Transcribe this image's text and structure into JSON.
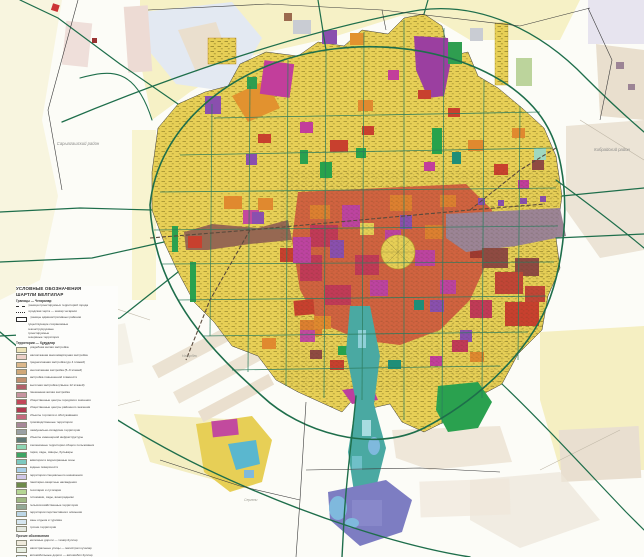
{
  "map": {
    "type": "city-master-plan",
    "region_labels": [
      {
        "id": "left",
        "text": "Сарыагашский район"
      },
      {
        "id": "right",
        "text": "Кибрайский район"
      }
    ],
    "place_labels": [
      {
        "id": "sw-settlement",
        "text": "Назарбек"
      },
      {
        "id": "s-settlement",
        "text": "Сергели"
      }
    ],
    "colors": {
      "background": "#fcfcf7",
      "pale_fields": "#f6f1c6",
      "outskirt_beige": "#ebe2d2",
      "city_yellow": "#e7cf56",
      "street_texture": "#6b5e14",
      "highway_green": "#1e6e4b",
      "grid_teal": "#2c7c5e",
      "park_green": "#27a24c",
      "residential_red": "#cf5a3e",
      "crimson": "#c13a57",
      "magenta": "#c23e9b",
      "purple": "#8a4fae",
      "orange": "#e0892f",
      "industrial_mauve": "#9c8495",
      "rail_brown": "#966852",
      "canal_teal": "#4aa9a2",
      "lake_blue": "#7fb9dd",
      "special_slate": "#7d7dc2",
      "boundary_black": "#3a3a3a"
    }
  },
  "legend": {
    "title_ru": "УСЛОВНЫЕ ОБОЗНАЧЕНИЯ",
    "title_uz": "ШАРТЛИ БЕЛГИЛАР",
    "sections": [
      {
        "header": "Границы — Чегаралар",
        "entries": [
          {
            "type": "line-dashdot",
            "label": "граница проектируемых территорий города"
          },
          {
            "type": "line-dash",
            "label": "городская черта — шахар чегараси"
          },
          {
            "type": "box",
            "label": "границы административных районов"
          }
        ]
      },
      {
        "header": "",
        "entries": [
          {
            "type": "text",
            "label": "существующие сохраняемые"
          },
          {
            "type": "text",
            "label": "реконструируемые"
          },
          {
            "type": "text",
            "label": "проектируемые"
          },
          {
            "type": "text",
            "label": "резервные территории"
          }
        ]
      },
      {
        "header": "Территории — Худудлар",
        "entries": [
          {
            "type": "swatch",
            "color": "#eee4b8",
            "label": "усадебная жилая застройка"
          },
          {
            "type": "swatch",
            "color": "#ecd0c8",
            "label": "малоэтажная многоквартирная застройка"
          },
          {
            "type": "swatch",
            "color": "#dcb88c",
            "label": "среднеэтажная застройка (до 4 этажей)"
          },
          {
            "type": "swatch",
            "color": "#d0a878",
            "label": "многоэтажная застройка (5–9 этажей)"
          },
          {
            "type": "swatch",
            "color": "#c09070",
            "label": "застройка повышенной этажности"
          },
          {
            "type": "swatch",
            "color": "#b0606a",
            "label": "высотная застройка (свыше 12 этажей)"
          },
          {
            "type": "swatch",
            "color": "#c794a0",
            "label": "смешанная жилая застройка"
          },
          {
            "type": "swatch",
            "color": "#c2485a",
            "label": "общественные центры городского значения"
          },
          {
            "type": "swatch",
            "color": "#b03a50",
            "label": "общественные центры районного значения"
          },
          {
            "type": "swatch",
            "color": "#c46a7e",
            "label": "объекты торговли и обслуживания"
          },
          {
            "type": "swatch",
            "color": "#a78898",
            "label": "производственные территории"
          },
          {
            "type": "swatch",
            "color": "#9aa0a4",
            "label": "коммунально-складские территории"
          },
          {
            "type": "swatch",
            "color": "#5f7a78",
            "label": "объекты инженерной инфраструктуры"
          },
          {
            "type": "swatch",
            "color": "#8fd6b4",
            "label": "озеленённые территории общего пользования"
          },
          {
            "type": "swatch",
            "color": "#3da564",
            "label": "парки, сады, скверы, бульвары"
          },
          {
            "type": "swatch",
            "color": "#7cc9c0",
            "label": "акватории и водоохранные зоны"
          },
          {
            "type": "swatch",
            "color": "#a9cfe8",
            "label": "водные поверхности"
          },
          {
            "type": "swatch",
            "color": "#cfc6e6",
            "label": "территории специального назначения"
          },
          {
            "type": "swatch",
            "color": "#6d8a4a",
            "label": "санитарно-защитные насаждения"
          },
          {
            "type": "swatch",
            "color": "#b5d694",
            "label": "лесопарки и лугопарки"
          },
          {
            "type": "swatch",
            "color": "#9fb884",
            "label": "питомники, сады, виноградники"
          },
          {
            "type": "swatch",
            "color": "#93a896",
            "label": "сельскохозяйственные территории"
          },
          {
            "type": "swatch",
            "color": "#bcd6e6",
            "label": "территории перспективного освоения"
          },
          {
            "type": "swatch",
            "color": "#d6e6f0",
            "label": "зоны отдыха и туризма"
          },
          {
            "type": "swatch",
            "color": "#e4e8e0",
            "label": "прочие территории"
          }
        ]
      },
      {
        "header": "Прочие обозначения",
        "entries": [
          {
            "type": "swatch",
            "color": "#efeadc",
            "label": "железные дороги — темир йуллар"
          },
          {
            "type": "swatch",
            "color": "#e7efe2",
            "label": "магистральные улицы — магистрал кучалар"
          },
          {
            "type": "swatch",
            "color": "#e3ecf2",
            "label": "автомобильные дороги — автомобил йуллар"
          }
        ]
      }
    ]
  }
}
